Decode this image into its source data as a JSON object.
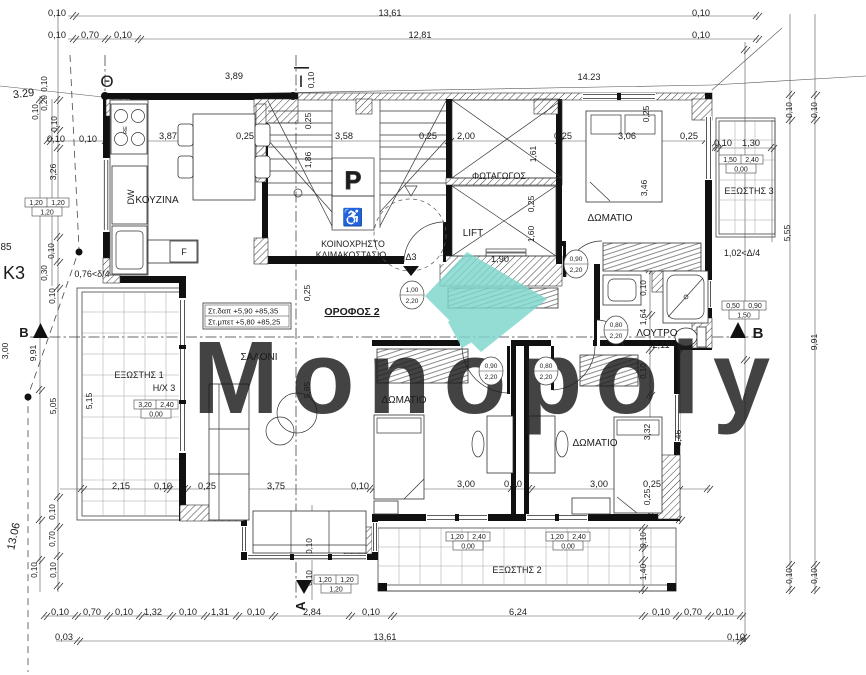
{
  "meta": {
    "watermark": "Monopoly",
    "accent": "#7CD6CD",
    "drawing": "floor-plan-orofos-2"
  },
  "rooms": {
    "kitchen": "ΚΟΥΖΙΝΑ",
    "living": "ΣΑΛΟΝΙ",
    "bedroom": "ΔΩΜΑΤΙΟ",
    "bath": "ΛΟΥΤΡΟ",
    "stair1": "ΚΟΙΝΟΧΡΗΣΤΟ",
    "stair2": "ΚΛΙΜΑΚΟΣΤΑΣΙΟ",
    "lightwell": "ΦΩΤΑΓΩΓΟΣ",
    "lift": "LIFT",
    "balcony1": "ΕΞΩΣΤΗΣ 1",
    "balcony2": "ΕΞΩΣΤΗΣ 2",
    "balcony3": "ΕΞΩΣΤΗΣ 3",
    "floor": "ΟΡΟΦΟΣ 2"
  },
  "levels_box": {
    "line1": "Στ.δαπ  +5,90  +85,35",
    "line2": "Στ.μπετ +5,80  +85,25"
  },
  "labels": [
    {
      "n": "dim-label",
      "t": "0,10",
      "x": 57,
      "y": 16
    },
    {
      "n": "dim-label",
      "t": "13,61",
      "x": 390,
      "y": 16
    },
    {
      "n": "dim-label",
      "t": "0,10",
      "x": 701,
      "y": 16
    },
    {
      "n": "dim-label",
      "t": "0,10",
      "x": 57,
      "y": 38
    },
    {
      "n": "dim-label",
      "t": "0,70",
      "x": 90,
      "y": 38
    },
    {
      "n": "dim-label",
      "t": "0,10",
      "x": 123,
      "y": 38
    },
    {
      "n": "dim-label",
      "t": "12,81",
      "x": 420,
      "y": 38
    },
    {
      "n": "dim-label",
      "t": "0,10",
      "x": 701,
      "y": 38
    },
    {
      "n": "axis-theta-label",
      "t": "Θ",
      "x": 107,
      "y": 87,
      "s": 17
    },
    {
      "n": "axis-iota-label",
      "t": "Ι",
      "x": 301,
      "y": 87,
      "s": 17
    },
    {
      "n": "dim-label",
      "t": "0,10",
      "x": 314,
      "y": 80,
      "r": -90,
      "s": 8.5
    },
    {
      "n": "dim-label",
      "t": "3,89",
      "x": 234,
      "y": 79
    },
    {
      "n": "dim-label",
      "t": "14.23",
      "x": 589,
      "y": 80
    },
    {
      "n": "dim-label",
      "t": "3.29",
      "x": 24,
      "y": 97,
      "s": 11,
      "r": -7
    },
    {
      "n": "dim-label",
      "t": "0,10",
      "x": 47,
      "y": 84,
      "r": -90,
      "s": 8
    },
    {
      "n": "dim-label",
      "t": "0,20",
      "x": 47,
      "y": 103,
      "r": -90,
      "s": 8
    },
    {
      "n": "dim-label",
      "t": "0,10",
      "x": 38,
      "y": 112,
      "r": -90,
      "s": 8
    },
    {
      "n": "dim-label",
      "t": "0,10",
      "x": 57,
      "y": 124,
      "r": -90,
      "s": 8
    },
    {
      "n": "dim-label",
      "t": "0,10",
      "x": 56,
      "y": 142
    },
    {
      "n": "dim-label",
      "t": "0,10",
      "x": 88,
      "y": 142
    },
    {
      "n": "dim-label",
      "t": "3,87",
      "x": 168,
      "y": 139
    },
    {
      "n": "dim-label",
      "t": "0,25",
      "x": 245,
      "y": 139
    },
    {
      "n": "dim-label",
      "t": "3,58",
      "x": 344,
      "y": 139
    },
    {
      "n": "dim-label",
      "t": "0,25",
      "x": 428,
      "y": 139
    },
    {
      "n": "dim-label",
      "t": "2,00",
      "x": 466,
      "y": 139
    },
    {
      "n": "dim-label",
      "t": "0,25",
      "x": 563,
      "y": 139
    },
    {
      "n": "dim-label",
      "t": "3,06",
      "x": 627,
      "y": 139
    },
    {
      "n": "dim-label",
      "t": "0,25",
      "x": 689,
      "y": 139
    },
    {
      "n": "dim-label",
      "t": "0,10",
      "x": 723,
      "y": 146
    },
    {
      "n": "dim-label",
      "t": "1,30",
      "x": 751,
      "y": 146
    },
    {
      "n": "dim-label",
      "t": "0,25",
      "x": 311,
      "y": 121,
      "r": -90,
      "s": 8.5
    },
    {
      "n": "dim-label",
      "t": "1,86",
      "x": 311,
      "y": 160,
      "r": -90,
      "s": 8.5
    },
    {
      "n": "dim-label",
      "t": "1,61",
      "x": 536,
      "y": 154,
      "r": -90,
      "s": 8.5
    },
    {
      "n": "dim-label",
      "t": "0,25",
      "x": 534,
      "y": 204,
      "r": -90,
      "s": 8.5
    },
    {
      "n": "dim-label",
      "t": "1,60",
      "x": 534,
      "y": 234,
      "r": -90,
      "s": 8.5
    },
    {
      "n": "dim-label",
      "t": "1,90",
      "x": 500,
      "y": 262
    },
    {
      "n": "room-label",
      "t": "ΦΩΤΑΓΩΓΟΣ",
      "x": 499,
      "y": 179,
      "s": 9
    },
    {
      "n": "room-label",
      "t": "LIFT",
      "x": 473,
      "y": 236,
      "s": 10
    },
    {
      "n": "room-label",
      "t": "ΚΟΙΝΟΧΡΗΣΤΟ",
      "x": 353,
      "y": 247,
      "s": 8.8
    },
    {
      "n": "room-label",
      "t": "ΚΛΙΜΑΚΟΣΤΑΣΙΟ",
      "x": 351,
      "y": 258,
      "s": 8.8
    },
    {
      "n": "door-label",
      "t": "Δ3",
      "x": 411,
      "y": 260,
      "s": 9
    },
    {
      "n": "dim-label",
      "t": "0,25",
      "x": 649,
      "y": 114,
      "r": -90,
      "s": 8.5
    },
    {
      "n": "dim-label",
      "t": "3,46",
      "x": 647,
      "y": 188,
      "r": -90,
      "s": 8.5
    },
    {
      "n": "room-label",
      "t": "ΔΩΜΑΤΙΟ",
      "x": 610,
      "y": 221,
      "s": 10
    },
    {
      "n": "dim-label",
      "t": "3,26",
      "x": 56,
      "y": 172,
      "r": -90,
      "s": 8.5
    },
    {
      "n": "dim-label",
      "t": "0,10",
      "x": 54,
      "y": 251,
      "r": -90,
      "s": 8
    },
    {
      "n": "dim-label",
      "t": "0,30",
      "x": 47,
      "y": 273,
      "r": -90,
      "s": 8
    },
    {
      "n": "dim-label",
      "t": "0,10",
      "x": 55,
      "y": 296,
      "r": -90,
      "s": 8
    },
    {
      "n": "note-label",
      "t": "0,76<δ/4",
      "x": 92,
      "y": 277,
      "s": 9
    },
    {
      "n": "point-label",
      "t": "Κ3",
      "x": 14,
      "y": 279,
      "s": 18
    },
    {
      "n": "point-label",
      "t": "85",
      "x": 6,
      "y": 250,
      "s": 10
    },
    {
      "n": "section-label",
      "t": "Β",
      "x": 24,
      "y": 337,
      "s": 13,
      "w": "bold"
    },
    {
      "n": "section-label",
      "t": "Β",
      "x": 758,
      "y": 338,
      "s": 15,
      "w": "bold"
    },
    {
      "n": "dim-label",
      "t": "3,00",
      "x": 8,
      "y": 351,
      "r": -90,
      "s": 8.5
    },
    {
      "n": "dim-label",
      "t": "9,91",
      "x": 36,
      "y": 353,
      "r": -90,
      "s": 8.5
    },
    {
      "n": "dim-label",
      "t": "13.06",
      "x": 17,
      "y": 537,
      "r": -78,
      "s": 11
    },
    {
      "n": "dim-label",
      "t": "5,05",
      "x": 56,
      "y": 406,
      "r": -90,
      "s": 8.5
    },
    {
      "n": "dim-label",
      "t": "0,10",
      "x": 55,
      "y": 512,
      "r": -90,
      "s": 8
    },
    {
      "n": "dim-label",
      "t": "0,70",
      "x": 55,
      "y": 539,
      "r": -90,
      "s": 8
    },
    {
      "n": "dim-label",
      "t": "0,10",
      "x": 37,
      "y": 570,
      "r": -90,
      "s": 8
    },
    {
      "n": "dim-label",
      "t": "0,10",
      "x": 56,
      "y": 570,
      "r": -90,
      "s": 8
    },
    {
      "n": "room-label",
      "t": "ΕΞΩΣΤΗΣ 1",
      "x": 139,
      "y": 378,
      "s": 9
    },
    {
      "n": "note-label",
      "t": "Η/Χ 3",
      "x": 164,
      "y": 391,
      "s": 9
    },
    {
      "n": "dim-label",
      "t": "5,15",
      "x": 92,
      "y": 401,
      "r": -90,
      "s": 8.5
    },
    {
      "n": "room-label",
      "t": "ΣΑΛΟΝΙ",
      "x": 259,
      "y": 360,
      "s": 10
    },
    {
      "n": "dim-label",
      "t": "0,25",
      "x": 310,
      "y": 293,
      "r": -90,
      "s": 8.5
    },
    {
      "n": "dim-label",
      "t": "5,85",
      "x": 310,
      "y": 390,
      "r": -90,
      "s": 8.5
    },
    {
      "n": "floor-label",
      "t": "ΟΡΟΦΟΣ 2",
      "x": 352,
      "y": 315,
      "s": 10.5,
      "w": "bold",
      "u": 1
    },
    {
      "n": "room-label",
      "t": "ΔΩΜΑΤΙΟ",
      "x": 404,
      "y": 403,
      "s": 10
    },
    {
      "n": "room-label",
      "t": "ΔΩΜΑΤΙΟ",
      "x": 595,
      "y": 446,
      "s": 10
    },
    {
      "n": "room-label",
      "t": "ΛΟΥΤΡΟ",
      "x": 657,
      "y": 336,
      "s": 10
    },
    {
      "n": "dim-label",
      "t": "2,11",
      "x": 661,
      "y": 348
    },
    {
      "n": "dim-label",
      "t": "1,64",
      "x": 646,
      "y": 317,
      "r": -90,
      "s": 8.5
    },
    {
      "n": "dim-label",
      "t": "0,10",
      "x": 646,
      "y": 288,
      "r": -90,
      "s": 8
    },
    {
      "n": "dim-label",
      "t": "0,10",
      "x": 646,
      "y": 371,
      "r": -90,
      "s": 8
    },
    {
      "n": "dim-label",
      "t": "3,32",
      "x": 650,
      "y": 432,
      "r": -90,
      "s": 8.5
    },
    {
      "n": "dim-label",
      "t": "0,25",
      "x": 650,
      "y": 497,
      "r": -90,
      "s": 8.5
    },
    {
      "n": "dim-label",
      "t": "3,46",
      "x": 681,
      "y": 438,
      "r": -90,
      "s": 8.5
    },
    {
      "n": "dim-label",
      "t": "2,15",
      "x": 121,
      "y": 489
    },
    {
      "n": "dim-label",
      "t": "0,10",
      "x": 163,
      "y": 489
    },
    {
      "n": "dim-label",
      "t": "0,25",
      "x": 207,
      "y": 489
    },
    {
      "n": "dim-label",
      "t": "3,75",
      "x": 276,
      "y": 489
    },
    {
      "n": "dim-label",
      "t": "0,10",
      "x": 360,
      "y": 489
    },
    {
      "n": "dim-label",
      "t": "3,00",
      "x": 466,
      "y": 487
    },
    {
      "n": "dim-label",
      "t": "0,10",
      "x": 513,
      "y": 487
    },
    {
      "n": "dim-label",
      "t": "3,00",
      "x": 599,
      "y": 487
    },
    {
      "n": "dim-label",
      "t": "0,25",
      "x": 652,
      "y": 487
    },
    {
      "n": "dim-label",
      "t": "0,10",
      "x": 312,
      "y": 546,
      "r": -90,
      "s": 8
    },
    {
      "n": "dim-label",
      "t": "0,10",
      "x": 312,
      "y": 578,
      "r": -90,
      "s": 8
    },
    {
      "n": "section-label",
      "t": "Α",
      "x": 305,
      "y": 606,
      "r": -90,
      "s": 13,
      "w": "bold"
    },
    {
      "n": "room-label",
      "t": "ΕΞΩΣΤΗΣ 2",
      "x": 517,
      "y": 573,
      "s": 9
    },
    {
      "n": "dim-label",
      "t": "0,10",
      "x": 646,
      "y": 540,
      "r": -90,
      "s": 8
    },
    {
      "n": "dim-label",
      "t": "1,40",
      "x": 646,
      "y": 572,
      "r": -90,
      "s": 8.5
    },
    {
      "n": "dim-label",
      "t": "0,10",
      "x": 60,
      "y": 615
    },
    {
      "n": "dim-label",
      "t": "0,70",
      "x": 92,
      "y": 615
    },
    {
      "n": "dim-label",
      "t": "0,10",
      "x": 124,
      "y": 615
    },
    {
      "n": "dim-label",
      "t": "1,32",
      "x": 153,
      "y": 615
    },
    {
      "n": "dim-label",
      "t": "0,10",
      "x": 188,
      "y": 615
    },
    {
      "n": "dim-label",
      "t": "1,31",
      "x": 220,
      "y": 615
    },
    {
      "n": "dim-label",
      "t": "0,10",
      "x": 256,
      "y": 615
    },
    {
      "n": "dim-label",
      "t": "2,84",
      "x": 312,
      "y": 615
    },
    {
      "n": "dim-label",
      "t": "0,10",
      "x": 371,
      "y": 615
    },
    {
      "n": "dim-label",
      "t": "6,24",
      "x": 518,
      "y": 615
    },
    {
      "n": "dim-label",
      "t": "0,10",
      "x": 661,
      "y": 615
    },
    {
      "n": "dim-label",
      "t": "0,70",
      "x": 693,
      "y": 615
    },
    {
      "n": "dim-label",
      "t": "0,10",
      "x": 725,
      "y": 615
    },
    {
      "n": "dim-label",
      "t": "0,03",
      "x": 64,
      "y": 640
    },
    {
      "n": "dim-label",
      "t": "13,61",
      "x": 385,
      "y": 640
    },
    {
      "n": "dim-label",
      "t": "0,10",
      "x": 736,
      "y": 640
    },
    {
      "n": "dim-label",
      "t": "0,10",
      "x": 792,
      "y": 110,
      "r": -90,
      "s": 8
    },
    {
      "n": "dim-label",
      "t": "0,10",
      "x": 817,
      "y": 110,
      "r": -90,
      "s": 8
    },
    {
      "n": "dim-label",
      "t": "5,55",
      "x": 790,
      "y": 233,
      "r": -90,
      "s": 8.5
    },
    {
      "n": "note-label",
      "t": "1,02<Δ/4",
      "x": 742,
      "y": 256,
      "s": 9
    },
    {
      "n": "dim-label",
      "t": "9,91",
      "x": 817,
      "y": 342,
      "r": -90,
      "s": 8.5
    },
    {
      "n": "dim-label",
      "t": "0,10",
      "x": 792,
      "y": 576,
      "r": -90,
      "s": 8
    },
    {
      "n": "dim-label",
      "t": "0,10",
      "x": 817,
      "y": 576,
      "r": -90,
      "s": 8
    },
    {
      "n": "room-label",
      "t": "ΕΞΩΣΤΗΣ 3",
      "x": 749,
      "y": 194,
      "s": 9
    },
    {
      "n": "room-label",
      "t": "ΚΟΥΖΙΝΑ",
      "x": 157,
      "y": 203,
      "s": 10
    },
    {
      "n": "appliance-label",
      "t": "DW",
      "x": 134,
      "y": 197,
      "r": -90,
      "s": 9
    },
    {
      "n": "appliance-label",
      "t": "F",
      "x": 184,
      "y": 255,
      "s": 9
    },
    {
      "n": "appliance-label",
      "t": "RE",
      "x": 127,
      "y": 130,
      "r": -90,
      "s": 5.5
    },
    {
      "n": "parking-sign",
      "t": "P",
      "x": 353,
      "y": 189,
      "s": 25,
      "w": "bold",
      "o": 1
    },
    {
      "n": "wheelchair-icon",
      "t": "♿",
      "x": 353,
      "y": 223,
      "s": 17
    }
  ],
  "dim_boxes": [
    {
      "n": "window-tag",
      "x": 47,
      "y": 207,
      "c1": "1,20",
      "c2": "1,20",
      "b": "1,20"
    },
    {
      "n": "window-tag",
      "x": 156,
      "y": 409,
      "c1": "3,20",
      "c2": "2,40",
      "b": "0,00"
    },
    {
      "n": "window-tag",
      "x": 741,
      "y": 164,
      "c1": "1,50",
      "c2": "2,40",
      "b": "0,00"
    },
    {
      "n": "window-tag",
      "x": 744,
      "y": 310,
      "c1": "0,50",
      "c2": "0,90",
      "b": "1,50"
    },
    {
      "n": "window-tag",
      "x": 468,
      "y": 541,
      "c1": "1,20",
      "c2": "2,40",
      "b": "0,00"
    },
    {
      "n": "window-tag",
      "x": 568,
      "y": 541,
      "c1": "1,20",
      "c2": "2,40",
      "b": "0,00"
    },
    {
      "n": "window-tag",
      "x": 336,
      "y": 584,
      "c1": "1,20",
      "c2": "1,20",
      "b": "1,20"
    }
  ],
  "door_tags": [
    {
      "n": "door-size-tag",
      "x": 412,
      "y": 295,
      "a": "1,00",
      "b": "2,20"
    },
    {
      "n": "door-size-tag",
      "x": 576,
      "y": 264,
      "a": "0,90",
      "b": "2,20"
    },
    {
      "n": "door-size-tag",
      "x": 616,
      "y": 330,
      "a": "0,80",
      "b": "2,20"
    },
    {
      "n": "door-size-tag",
      "x": 491,
      "y": 371,
      "a": "0,90",
      "b": "2,20"
    },
    {
      "n": "door-size-tag",
      "x": 546,
      "y": 371,
      "a": "0,80",
      "b": "2,20"
    }
  ]
}
